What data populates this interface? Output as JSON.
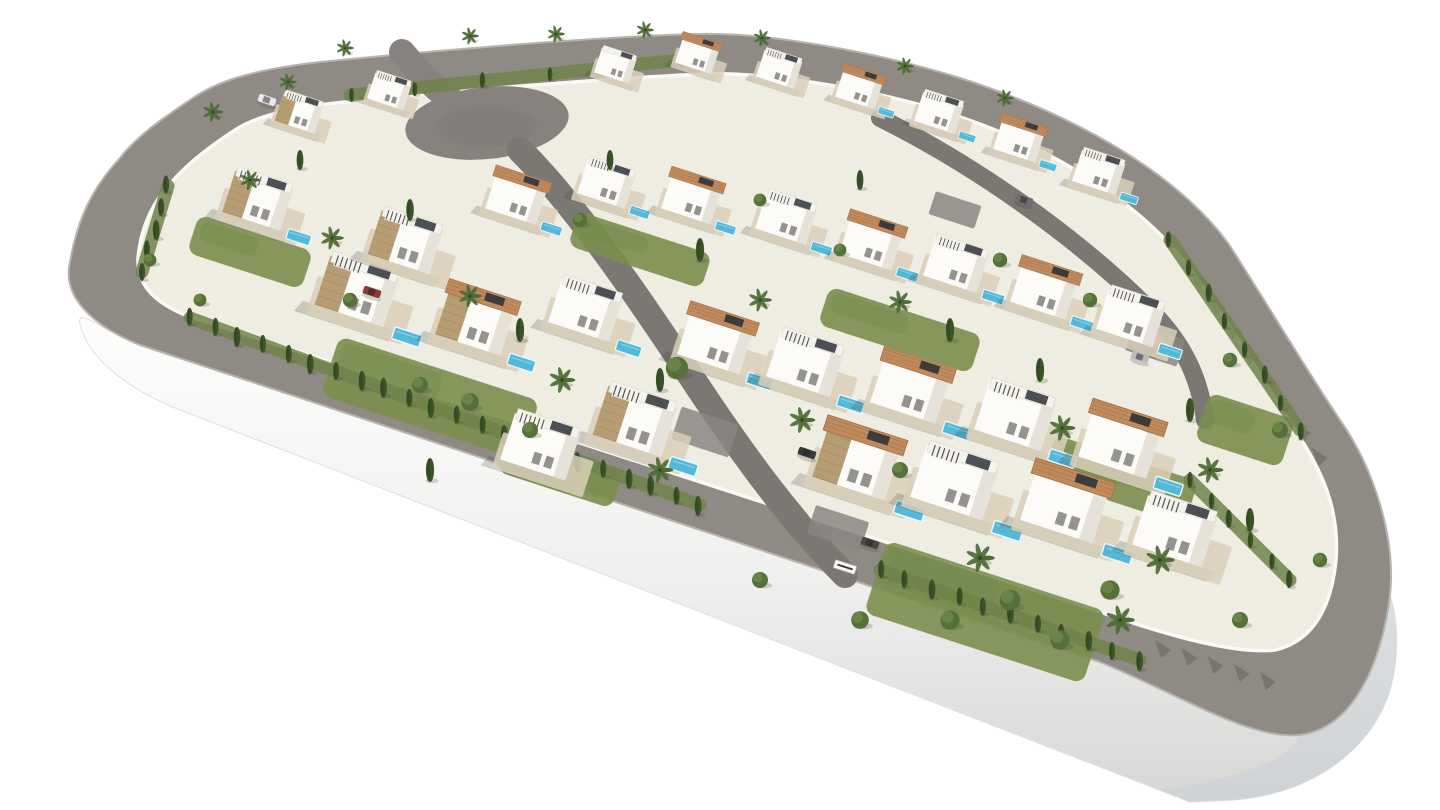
{
  "description": "Aerial 3D architectural rendering of a gated residential development: modern white villas with stone accent walls, terracotta roofs and private pools on a teardrop-shaped plot encircled by a grey perimeter road, presented on a plain white background",
  "image": {
    "width": 1440,
    "height": 810,
    "background": "#ffffff"
  },
  "palette": {
    "road": "#8f8a84",
    "road_curb": "#b7b3ae",
    "road_inner": "#7b7773",
    "culdesac": "#87827d",
    "ground": "#efece2",
    "terrace": "#d9cfb8",
    "plaza": "#8a8681",
    "wall_white": "#fcfbf7",
    "wall_shade": "#e6e2d9",
    "stone": "#b79d74",
    "stone_line": "#9c825c",
    "tile_roof": "#c18a5c",
    "tile_line": "#9e6f47",
    "flat_roof": "#f4f2ec",
    "pergola": "#514f49",
    "panel": "#2e3338",
    "pool": "#54b9d8",
    "pool_rim": "#eaf8fc",
    "lawn": "#7b8e4e",
    "hedge_band": "#70834a",
    "cypress": "#3b5328",
    "cypress_dark": "#2f4520",
    "bush": "#55713a",
    "bush_light": "#6d8a4a",
    "palm": "#4c6b33",
    "trunk": "#8a7a5e",
    "plinth_edge": "#e0e0de",
    "plinth_shade": "#c9cfd6",
    "shadow": "rgba(70,68,62,0.22)"
  },
  "scene": {
    "platform": {
      "outer": "M 120,158 C 95,185 78,215 70,262 C 62,295 90,325 140,345 L 1100,662 C 1180,695 1250,740 1300,735 C 1355,728 1382,660 1390,595 C 1396,540 1375,470 1340,420 C 1300,360 1265,300 1228,243 C 1170,165 1060,110 960,78 C 870,50 760,32 700,34 C 600,36 420,52 320,62 C 250,70 215,82 190,100 C 160,120 135,138 120,158 Z",
      "inner": "M 165,190 C 148,210 140,235 138,258 C 137,282 150,300 185,315 L 1080,605 C 1150,630 1230,655 1275,650 C 1318,640 1332,600 1336,560 C 1340,510 1322,470 1295,430 C 1258,372 1222,310 1185,262 C 1130,193 1035,140 945,112 C 860,86 760,72 705,74 C 610,78 440,92 345,102 C 285,108 252,118 232,132 C 205,150 182,168 165,190 Z",
      "plinth": "M 140,345 L 1100,662 C 1180,695 1250,740 1300,735 C 1355,728 1382,660 1390,595 C 1398,620 1398,650 1394,672 C 1384,740 1320,793 1235,800 L 1190,802 L 175,408 C 120,385 88,355 80,325 C 76,305 100,330 140,345 Z",
      "plinth_corner": "M 1300,735 C 1355,728 1382,660 1390,595 C 1398,620 1398,650 1394,672 C 1384,740 1320,793 1235,800 L 1190,802 L 1160,790 C 1245,778 1288,760 1300,735 Z"
    },
    "culdesac": {
      "cx": 487,
      "cy": 123,
      "rx": 82,
      "ry": 36,
      "rot": -6
    },
    "road_stub": {
      "d": "M 402,52 C 428,84 450,100 468,112",
      "w": 26
    },
    "internal_roads": [
      {
        "d": "M 520,150 C 580,210 640,300 700,390 C 740,450 790,520 845,575",
        "w": 26
      },
      {
        "d": "M 880,118 C 980,168 1080,240 1150,310 C 1185,345 1200,380 1205,420",
        "w": 18
      }
    ],
    "plazas": [
      {
        "x": 705,
        "y": 432,
        "w": 60,
        "h": 34
      },
      {
        "x": 838,
        "y": 528,
        "w": 56,
        "h": 30
      },
      {
        "x": 1155,
        "y": 345,
        "w": 54,
        "h": 28
      },
      {
        "x": 955,
        "y": 210,
        "w": 48,
        "h": 24
      }
    ],
    "lawns": [
      {
        "x": 430,
        "y": 398,
        "w": 210,
        "h": 62
      },
      {
        "x": 985,
        "y": 612,
        "w": 230,
        "h": 76
      },
      {
        "x": 250,
        "y": 252,
        "w": 120,
        "h": 40
      },
      {
        "x": 640,
        "y": 250,
        "w": 140,
        "h": 36
      },
      {
        "x": 900,
        "y": 330,
        "w": 160,
        "h": 40
      },
      {
        "x": 1120,
        "y": 480,
        "w": 150,
        "h": 46
      },
      {
        "x": 560,
        "y": 472,
        "w": 120,
        "h": 38
      },
      {
        "x": 1245,
        "y": 430,
        "w": 90,
        "h": 50
      }
    ],
    "hedges": [
      {
        "x1": 168,
        "y1": 186,
        "x2": 142,
        "y2": 272,
        "n": 5,
        "s": 9
      },
      {
        "x1": 190,
        "y1": 318,
        "x2": 700,
        "y2": 505,
        "n": 22,
        "s": 9
      },
      {
        "x1": 880,
        "y1": 570,
        "x2": 1140,
        "y2": 660,
        "n": 11,
        "s": 9
      },
      {
        "x1": 1170,
        "y1": 240,
        "x2": 1300,
        "y2": 430,
        "n": 8,
        "s": 8
      },
      {
        "x1": 1190,
        "y1": 480,
        "x2": 1290,
        "y2": 580,
        "n": 6,
        "s": 8
      },
      {
        "x1": 350,
        "y1": 95,
        "x2": 680,
        "y2": 60,
        "n": 6,
        "s": 7
      }
    ],
    "shadow_teeth": [
      {
        "x1": 1192,
        "y1": 272,
        "x2": 1312,
        "y2": 448,
        "n": 8
      },
      {
        "x1": 1155,
        "y1": 640,
        "x2": 1260,
        "y2": 672,
        "n": 5
      }
    ],
    "villas": [
      {
        "x": 302,
        "y": 118,
        "s": 0.55,
        "roof": "flat",
        "stone": 1,
        "pool": null,
        "perg": 1
      },
      {
        "x": 392,
        "y": 96,
        "s": 0.5,
        "roof": "flat",
        "stone": 0,
        "pool": null,
        "perg": 1
      },
      {
        "x": 618,
        "y": 70,
        "s": 0.48,
        "roof": "flat",
        "stone": 0,
        "pool": null,
        "perg": 0
      },
      {
        "x": 700,
        "y": 60,
        "s": 0.5,
        "roof": "tile",
        "stone": 0,
        "pool": null,
        "perg": 0
      },
      {
        "x": 782,
        "y": 74,
        "s": 0.52,
        "roof": "flat",
        "stone": 0,
        "pool": null,
        "perg": 1
      },
      {
        "x": 862,
        "y": 94,
        "s": 0.54,
        "roof": "tile",
        "stone": 0,
        "pool": [
          38,
          12
        ],
        "perg": 0
      },
      {
        "x": 942,
        "y": 118,
        "s": 0.56,
        "roof": "flat",
        "stone": 0,
        "pool": [
          38,
          12
        ],
        "perg": 1
      },
      {
        "x": 1022,
        "y": 146,
        "s": 0.58,
        "roof": "tile",
        "stone": 0,
        "pool": [
          38,
          12
        ],
        "perg": 0
      },
      {
        "x": 1102,
        "y": 178,
        "s": 0.6,
        "roof": "flat",
        "stone": 0,
        "pool": [
          38,
          12
        ],
        "perg": 1
      },
      {
        "x": 262,
        "y": 208,
        "s": 0.8,
        "roof": "flat",
        "stone": 1,
        "pool": [
          40,
          14
        ],
        "perg": 1
      },
      {
        "x": 520,
        "y": 205,
        "s": 0.7,
        "roof": "tile",
        "stone": 0,
        "pool": [
          38,
          12
        ],
        "perg": 0
      },
      {
        "x": 610,
        "y": 190,
        "s": 0.66,
        "roof": "flat",
        "stone": 0,
        "pool": [
          38,
          12
        ],
        "perg": 1
      },
      {
        "x": 695,
        "y": 205,
        "s": 0.68,
        "roof": "tile",
        "stone": 0,
        "pool": [
          38,
          12
        ],
        "perg": 0
      },
      {
        "x": 790,
        "y": 225,
        "s": 0.7,
        "roof": "flat",
        "stone": 0,
        "pool": [
          38,
          12
        ],
        "perg": 1
      },
      {
        "x": 875,
        "y": 250,
        "s": 0.72,
        "roof": "tile",
        "stone": 0,
        "pool": [
          38,
          12
        ],
        "perg": 0
      },
      {
        "x": 960,
        "y": 272,
        "s": 0.74,
        "roof": "flat",
        "stone": 0,
        "pool": [
          38,
          12
        ],
        "perg": 1
      },
      {
        "x": 1048,
        "y": 298,
        "s": 0.76,
        "roof": "tile",
        "stone": 0,
        "pool": [
          38,
          12
        ],
        "perg": 0
      },
      {
        "x": 1135,
        "y": 325,
        "s": 0.78,
        "roof": "flat",
        "stone": 0,
        "pool": [
          38,
          12
        ],
        "perg": 1
      },
      {
        "x": 362,
        "y": 300,
        "s": 0.95,
        "roof": "flat",
        "stone": 1,
        "pool": [
          42,
          16
        ],
        "perg": 1
      },
      {
        "x": 480,
        "y": 330,
        "s": 0.9,
        "roof": "tile",
        "stone": 1,
        "pool": [
          40,
          14
        ],
        "perg": 0
      },
      {
        "x": 590,
        "y": 318,
        "s": 0.84,
        "roof": "flat",
        "stone": 0,
        "pool": [
          40,
          14
        ],
        "perg": 1
      },
      {
        "x": 720,
        "y": 350,
        "s": 0.86,
        "roof": "tile",
        "stone": 0,
        "pool": [
          40,
          14
        ],
        "perg": 0
      },
      {
        "x": 810,
        "y": 372,
        "s": 0.88,
        "roof": "flat",
        "stone": 0,
        "pool": [
          40,
          14
        ],
        "perg": 1
      },
      {
        "x": 915,
        "y": 398,
        "s": 0.9,
        "roof": "tile",
        "stone": 0,
        "pool": [
          40,
          14
        ],
        "perg": 0
      },
      {
        "x": 1020,
        "y": 425,
        "s": 0.92,
        "roof": "flat",
        "stone": 0,
        "pool": [
          40,
          14
        ],
        "perg": 1
      },
      {
        "x": 1125,
        "y": 452,
        "s": 0.94,
        "roof": "tile",
        "stone": 0,
        "pool": [
          40,
          14
        ],
        "perg": 0
      },
      {
        "x": 862,
        "y": 472,
        "s": 1.0,
        "roof": "tile",
        "stone": 1,
        "pool": [
          42,
          16
        ],
        "perg": 0
      },
      {
        "x": 960,
        "y": 492,
        "s": 1.0,
        "roof": "flat",
        "stone": 0,
        "pool": [
          42,
          16
        ],
        "perg": 1
      },
      {
        "x": 1070,
        "y": 515,
        "s": 1.0,
        "roof": "tile",
        "stone": 0,
        "pool": [
          42,
          16
        ],
        "perg": 0
      },
      {
        "x": 1180,
        "y": 540,
        "s": 0.96,
        "roof": "flat",
        "stone": 0,
        "pool": null,
        "perg": 1
      },
      {
        "x": 640,
        "y": 430,
        "s": 0.95,
        "roof": "flat",
        "stone": 1,
        "pool": [
          40,
          16
        ],
        "perg": 1
      },
      {
        "x": 545,
        "y": 455,
        "s": 0.9,
        "roof": "flat",
        "stone": 0,
        "pool": null,
        "perg": 1
      },
      {
        "x": 410,
        "y": 250,
        "s": 0.85,
        "roof": "flat",
        "stone": 1,
        "pool": null,
        "perg": 1
      }
    ],
    "trees": [
      {
        "t": "palm",
        "x": 213,
        "y": 112,
        "s": 7
      },
      {
        "t": "palm",
        "x": 288,
        "y": 82,
        "s": 6
      },
      {
        "t": "palm",
        "x": 345,
        "y": 48,
        "s": 6
      },
      {
        "t": "palm",
        "x": 470,
        "y": 36,
        "s": 6
      },
      {
        "t": "palm",
        "x": 556,
        "y": 34,
        "s": 6
      },
      {
        "t": "palm",
        "x": 645,
        "y": 30,
        "s": 6
      },
      {
        "t": "palm",
        "x": 762,
        "y": 38,
        "s": 6
      },
      {
        "t": "palm",
        "x": 905,
        "y": 66,
        "s": 6
      },
      {
        "t": "palm",
        "x": 1005,
        "y": 98,
        "s": 6
      },
      {
        "t": "palm",
        "x": 332,
        "y": 238,
        "s": 8
      },
      {
        "t": "palm",
        "x": 470,
        "y": 296,
        "s": 8
      },
      {
        "t": "palm",
        "x": 562,
        "y": 380,
        "s": 9
      },
      {
        "t": "palm",
        "x": 760,
        "y": 300,
        "s": 8
      },
      {
        "t": "palm",
        "x": 802,
        "y": 420,
        "s": 9
      },
      {
        "t": "palm",
        "x": 900,
        "y": 302,
        "s": 8
      },
      {
        "t": "palm",
        "x": 1062,
        "y": 428,
        "s": 9
      },
      {
        "t": "palm",
        "x": 980,
        "y": 558,
        "s": 10
      },
      {
        "t": "palm",
        "x": 1160,
        "y": 560,
        "s": 10
      },
      {
        "t": "palm",
        "x": 660,
        "y": 470,
        "s": 9
      },
      {
        "t": "palm",
        "x": 250,
        "y": 180,
        "s": 7
      },
      {
        "t": "palm",
        "x": 1210,
        "y": 470,
        "s": 9
      },
      {
        "t": "palm",
        "x": 1120,
        "y": 620,
        "s": 10
      },
      {
        "t": "cypress",
        "x": 300,
        "y": 160,
        "s": 10
      },
      {
        "t": "cypress",
        "x": 410,
        "y": 210,
        "s": 11
      },
      {
        "t": "cypress",
        "x": 610,
        "y": 160,
        "s": 10
      },
      {
        "t": "cypress",
        "x": 700,
        "y": 250,
        "s": 12
      },
      {
        "t": "cypress",
        "x": 860,
        "y": 180,
        "s": 10
      },
      {
        "t": "cypress",
        "x": 950,
        "y": 330,
        "s": 12
      },
      {
        "t": "cypress",
        "x": 1040,
        "y": 370,
        "s": 12
      },
      {
        "t": "cypress",
        "x": 520,
        "y": 330,
        "s": 12
      },
      {
        "t": "cypress",
        "x": 430,
        "y": 470,
        "s": 12
      },
      {
        "t": "cypress",
        "x": 1250,
        "y": 520,
        "s": 12
      },
      {
        "t": "cypress",
        "x": 660,
        "y": 380,
        "s": 12
      },
      {
        "t": "cypress",
        "x": 1190,
        "y": 410,
        "s": 12
      },
      {
        "t": "bush",
        "x": 677,
        "y": 368,
        "s": 14
      },
      {
        "t": "bush",
        "x": 420,
        "y": 385,
        "s": 10
      },
      {
        "t": "bush",
        "x": 470,
        "y": 402,
        "s": 11
      },
      {
        "t": "bush",
        "x": 950,
        "y": 620,
        "s": 12
      },
      {
        "t": "bush",
        "x": 1010,
        "y": 600,
        "s": 13
      },
      {
        "t": "bush",
        "x": 1060,
        "y": 640,
        "s": 12
      },
      {
        "t": "bush",
        "x": 1110,
        "y": 590,
        "s": 12
      },
      {
        "t": "bush",
        "x": 900,
        "y": 470,
        "s": 10
      },
      {
        "t": "bush",
        "x": 1230,
        "y": 360,
        "s": 9
      },
      {
        "t": "bush",
        "x": 1280,
        "y": 430,
        "s": 10
      },
      {
        "t": "bush",
        "x": 530,
        "y": 430,
        "s": 10
      },
      {
        "t": "bush",
        "x": 350,
        "y": 300,
        "s": 9
      },
      {
        "t": "bush",
        "x": 580,
        "y": 220,
        "s": 9
      },
      {
        "t": "bush",
        "x": 760,
        "y": 200,
        "s": 8
      },
      {
        "t": "bush",
        "x": 840,
        "y": 250,
        "s": 8
      },
      {
        "t": "bush",
        "x": 1000,
        "y": 260,
        "s": 9
      },
      {
        "t": "bush",
        "x": 1090,
        "y": 300,
        "s": 9
      },
      {
        "t": "bush",
        "x": 150,
        "y": 260,
        "s": 8
      },
      {
        "t": "bush",
        "x": 200,
        "y": 300,
        "s": 8
      },
      {
        "t": "bush",
        "x": 1320,
        "y": 560,
        "s": 9
      },
      {
        "t": "bush",
        "x": 1240,
        "y": 620,
        "s": 10
      },
      {
        "t": "bush",
        "x": 860,
        "y": 620,
        "s": 11
      },
      {
        "t": "bush",
        "x": 760,
        "y": 580,
        "s": 10
      }
    ],
    "cars": [
      {
        "x": 807,
        "y": 453,
        "c": "#3a3a38"
      },
      {
        "x": 870,
        "y": 543,
        "c": "#4a4845"
      },
      {
        "x": 1024,
        "y": 200,
        "c": "#6d6f71"
      },
      {
        "x": 1140,
        "y": 357,
        "c": "#b9bcbd"
      },
      {
        "x": 372,
        "y": 292,
        "c": "#8d3b36"
      },
      {
        "x": 267,
        "y": 100,
        "c": "#e8e8e6"
      }
    ],
    "gate": {
      "x": 845,
      "y": 567
    }
  }
}
